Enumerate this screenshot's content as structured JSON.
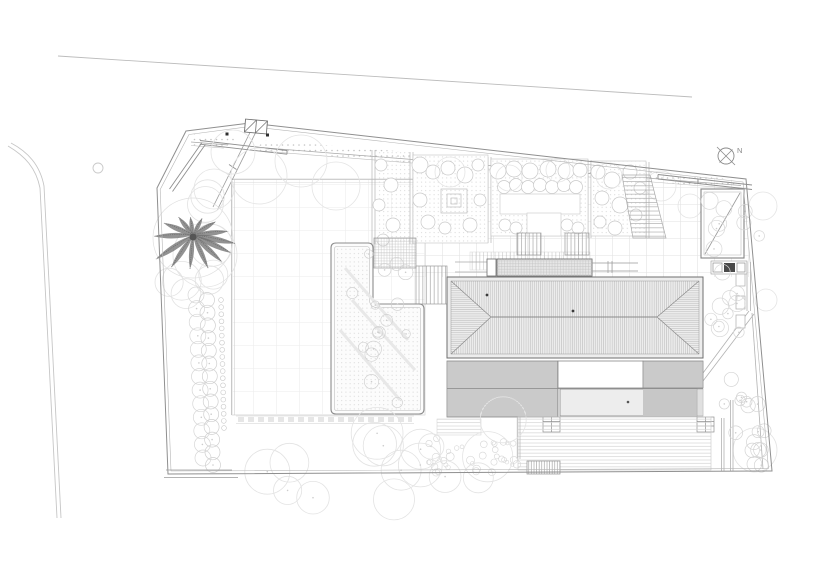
{
  "north_indicator": {
    "label": "N"
  },
  "colors": {
    "background": "#ffffff",
    "linework_light": "#cccccc",
    "linework_medium": "#999999",
    "linework_dark": "#555555",
    "roof_fill": "#ededed",
    "pergola_fill": "#e0e0e0",
    "pool_fill": "#ededed",
    "vegetation": "#d4d4d4",
    "palm_tree": "#6d6d6d",
    "accent_dot": "#333333"
  },
  "plan": {
    "type": "architectural-site-plan",
    "elements": [
      "road-edges",
      "site-boundary",
      "entry-gate",
      "driveway",
      "palm-tree",
      "hedge-row",
      "lawn",
      "l-shaped-planter",
      "garden-beds",
      "paved-terrace",
      "stairs",
      "main-house-hipped-roof",
      "entry-canopy",
      "pergola",
      "pool",
      "timber-deck",
      "stepping-stones",
      "garage",
      "equipment-pad",
      "side-garden",
      "north-arrow"
    ]
  }
}
